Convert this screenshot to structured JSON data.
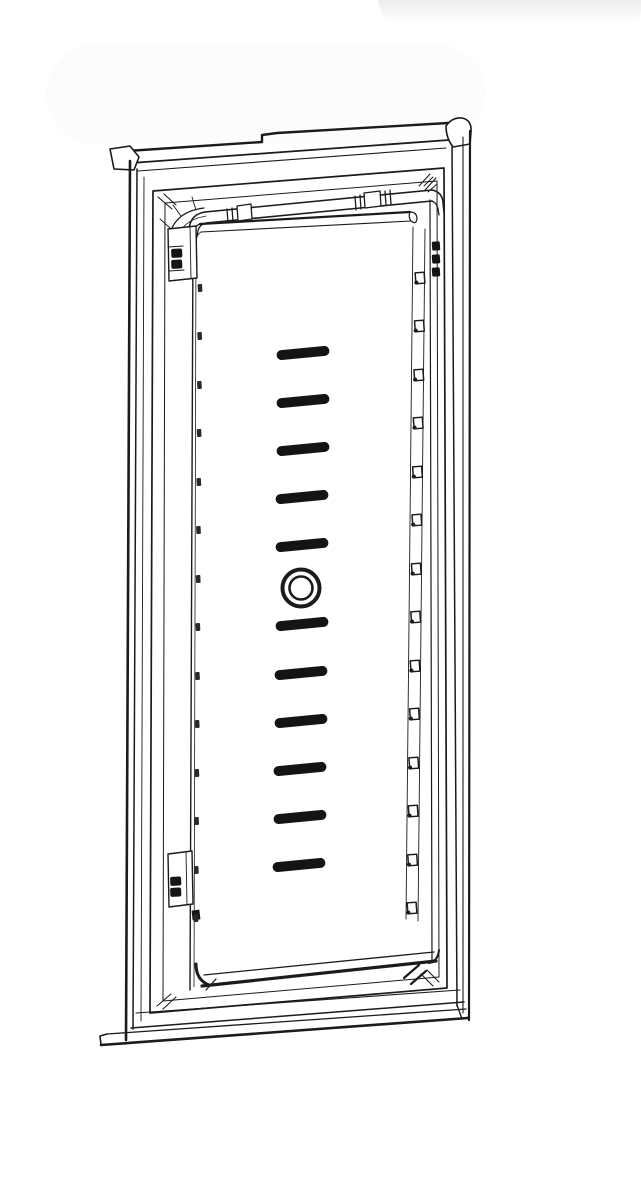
{
  "meta": {
    "subject": "technical-line-drawing-door-panel-assembly",
    "description": "Black-and-white perspective line drawing of a door inner panel (refrigerator-style) with outer frame, gasket frame, top tube rail with end fittings, hinge brackets, a vertical column of vent slots with a central round hole, and a row of small fastener holes along the right inner edge.",
    "background_color": "#ffffff",
    "line_color": "#1b1b1b",
    "visible_text": []
  },
  "drawing": {
    "canvas": {
      "width": 641,
      "height": 1200
    },
    "slot_style": {
      "width": 53,
      "height": 10,
      "rx": 5,
      "angle_deg": -5.5,
      "fill": "#141414"
    },
    "vent_slots": [
      {
        "cx": 303,
        "cy": 353
      },
      {
        "cx": 303,
        "cy": 401
      },
      {
        "cx": 303,
        "cy": 449
      },
      {
        "cx": 302,
        "cy": 497
      },
      {
        "cx": 302,
        "cy": 545
      },
      {
        "cx": 302,
        "cy": 624
      },
      {
        "cx": 301,
        "cy": 673
      },
      {
        "cx": 301,
        "cy": 721
      },
      {
        "cx": 300,
        "cy": 769
      },
      {
        "cx": 300,
        "cy": 817
      },
      {
        "cx": 299,
        "cy": 865
      }
    ],
    "center_hole": {
      "cx": 301,
      "cy": 588,
      "outer_r": 18.5,
      "inner_r": 11.5,
      "stroke_outer": 4,
      "stroke_inner": 2.6
    },
    "edge_hole_style": {
      "width": 9,
      "height": 11,
      "angle_deg": -4,
      "dot_r": 2.1
    },
    "edge_holes": [
      {
        "x": 420,
        "y": 278
      },
      {
        "x": 419.4,
        "y": 326
      },
      {
        "x": 418.8,
        "y": 375
      },
      {
        "x": 418.2,
        "y": 423
      },
      {
        "x": 417.5,
        "y": 472
      },
      {
        "x": 416.9,
        "y": 520
      },
      {
        "x": 416.3,
        "y": 569
      },
      {
        "x": 415.7,
        "y": 617
      },
      {
        "x": 415.1,
        "y": 666
      },
      {
        "x": 414.5,
        "y": 714
      },
      {
        "x": 413.8,
        "y": 763
      },
      {
        "x": 413.2,
        "y": 811
      },
      {
        "x": 412.6,
        "y": 860
      },
      {
        "x": 412,
        "y": 908
      }
    ],
    "left_tick_style": {
      "width": 4.5,
      "height": 8,
      "angle_deg": -3,
      "fill": "#2a2a2a"
    },
    "left_ticks": [
      {
        "x": 200,
        "y": 288
      },
      {
        "x": 199.7,
        "y": 336
      },
      {
        "x": 199.4,
        "y": 385
      },
      {
        "x": 199.1,
        "y": 433
      },
      {
        "x": 198.8,
        "y": 482
      },
      {
        "x": 198.5,
        "y": 530
      },
      {
        "x": 198.2,
        "y": 579
      },
      {
        "x": 197.9,
        "y": 627
      },
      {
        "x": 197.5,
        "y": 676
      },
      {
        "x": 197.2,
        "y": 724
      },
      {
        "x": 196.9,
        "y": 773
      },
      {
        "x": 196.6,
        "y": 821
      },
      {
        "x": 196.3,
        "y": 870
      },
      {
        "x": 196,
        "y": 918
      }
    ],
    "clip_style": {
      "width": 8,
      "height": 9,
      "fill": "#141414",
      "angle_deg": -4
    },
    "top_right_clips": [
      {
        "x": 436,
        "y": 246
      },
      {
        "x": 436,
        "y": 259
      },
      {
        "x": 436,
        "y": 272
      }
    ],
    "bracket_clip_style": {
      "width": 11,
      "height": 9,
      "fill": "#151515",
      "angle_deg": -3
    },
    "bracket_clips_top": [
      {
        "x": 171,
        "y": 249
      },
      {
        "x": 171,
        "y": 260
      }
    ],
    "bracket_clips_bottom": [
      {
        "x": 170,
        "y": 877
      },
      {
        "x": 170,
        "y": 888
      }
    ]
  }
}
